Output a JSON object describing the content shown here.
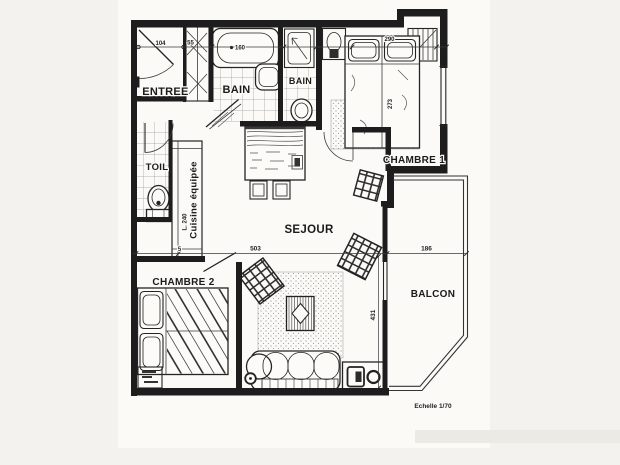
{
  "plan": {
    "rooms": {
      "entree": "ENTREE",
      "bain_gauche": "BAIN",
      "bain_droite": "BAIN",
      "chambre1": "CHAMBRE 1",
      "chambre2": "CHAMBRE 2",
      "sejour": "SEJOUR",
      "toilette": "TOIL",
      "cuisine": "Cuisine équipée",
      "balcon": "BALCON"
    },
    "dimensions": {
      "porte_entree": "104",
      "placard": "55",
      "baignoire": "160",
      "chambre1_largeur": "290",
      "chambre1_profondeur": "273",
      "cuisine_longueur": "L. 240",
      "mur": "5",
      "sejour_largeur": "503",
      "sejour_profondeur": "431",
      "balcon_largeur": "186"
    },
    "scale_label": "Echelle 1/70",
    "colors": {
      "ink": "#1d1d1d",
      "paper": "#fbfaf7",
      "page_bg": "#f3f2ee"
    },
    "symbols": [
      "entry-door",
      "wardrobe",
      "bathtub",
      "shower",
      "washbasin",
      "toilet",
      "double-bed",
      "rug",
      "dining-table",
      "chair",
      "armchair",
      "coffee-table",
      "sofa",
      "tv-stand",
      "kitchen-counter",
      "balcony-railing"
    ]
  }
}
